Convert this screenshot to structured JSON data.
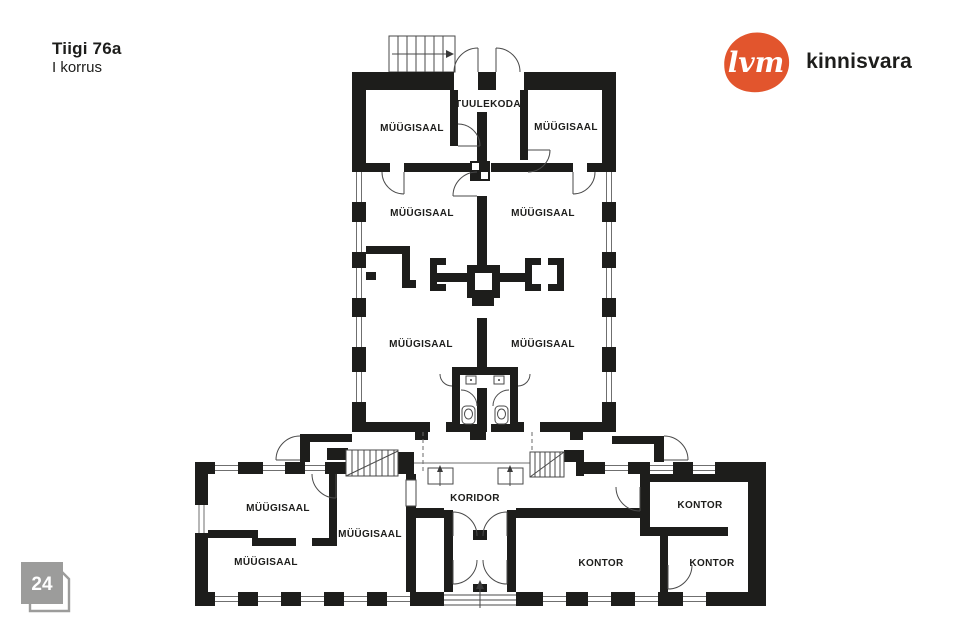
{
  "header": {
    "title": "Tiigi 76a",
    "subtitle": "I korrus"
  },
  "logo": {
    "mark": "lvm",
    "brand": "kinnisvara",
    "mark_bg": "#e2552d",
    "text_color": "#1d1d1b"
  },
  "page_badge": {
    "number": "24",
    "color": "#9c9c9b"
  },
  "floorplan": {
    "wall_color": "#1d1d1b",
    "rooms": [
      {
        "label": "TUULEKODA",
        "x": 488,
        "y": 104
      },
      {
        "label": "MÜÜGISAAL",
        "x": 412,
        "y": 128
      },
      {
        "label": "MÜÜGISAAL",
        "x": 566,
        "y": 127
      },
      {
        "label": "MÜÜGISAAL",
        "x": 422,
        "y": 213
      },
      {
        "label": "MÜÜGISAAL",
        "x": 543,
        "y": 213
      },
      {
        "label": "MÜÜGISAAL",
        "x": 421,
        "y": 344
      },
      {
        "label": "MÜÜGISAAL",
        "x": 543,
        "y": 344
      },
      {
        "label": "MÜÜGISAAL",
        "x": 278,
        "y": 508
      },
      {
        "label": "MÜÜGISAAL",
        "x": 370,
        "y": 534
      },
      {
        "label": "MÜÜGISAAL",
        "x": 266,
        "y": 562
      },
      {
        "label": "KORIDOR",
        "x": 475,
        "y": 498
      },
      {
        "label": "KONTOR",
        "x": 700,
        "y": 505
      },
      {
        "label": "KONTOR",
        "x": 601,
        "y": 563
      },
      {
        "label": "KONTOR",
        "x": 712,
        "y": 563
      }
    ]
  }
}
